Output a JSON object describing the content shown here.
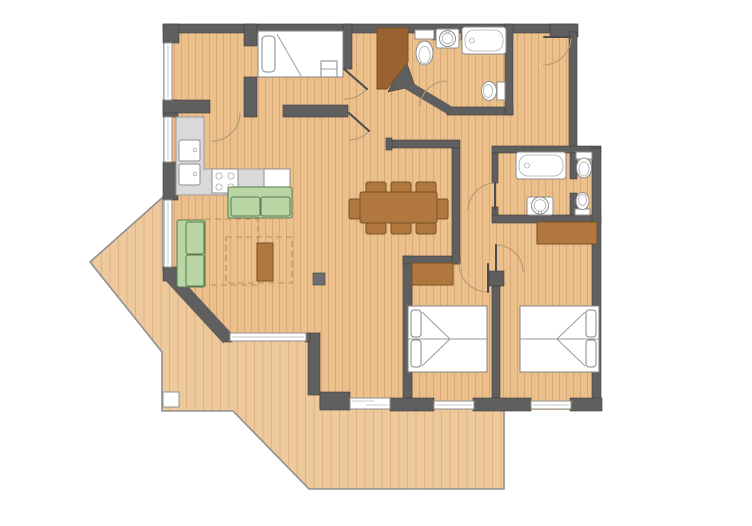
{
  "meta": {
    "type": "floor-plan",
    "rooms_count": 8,
    "bathrooms_count": 2,
    "bedrooms_count": 3
  },
  "colors": {
    "bg": "#ffffff",
    "floor": "#ecc08b",
    "floor_line": "#d9a876",
    "terrace": "#eec99b",
    "terrace_line": "#ddb285",
    "wall": "#5f5f5f",
    "window": "#ffffff",
    "counter": "#d9d9d9",
    "fixture": "#ffffff",
    "sofa": "#b9d7a5",
    "wood": "#b0783e",
    "door": "#9a6230",
    "bed": "#ffffff",
    "rug": "#b98e58",
    "arc": "#b09a77",
    "leaf": "#4b4b4b",
    "column": "#6e6e6e",
    "column_white": "#ffffff"
  },
  "semantics": {
    "rooms": [
      "bedroom-top-left",
      "bed-niche",
      "kitchen",
      "living-room",
      "dining-area",
      "entry-hall",
      "bathroom-1",
      "dressing-room",
      "bathroom-2",
      "corridor",
      "bedroom-1",
      "bedroom-2",
      "terrace"
    ],
    "furniture": [
      "single-bed",
      "double-bed-1",
      "double-bed-2",
      "sofa-horizontal",
      "sofa-vertical",
      "coffee-table",
      "dining-table",
      "dining-chairs",
      "wardrobe-1",
      "wardrobe-2",
      "kitchen-counter",
      "sink-unit",
      "stove",
      "fridge",
      "entrance-door"
    ],
    "fixtures": [
      "toilet",
      "washbasin",
      "bathtub",
      "bidet"
    ]
  }
}
